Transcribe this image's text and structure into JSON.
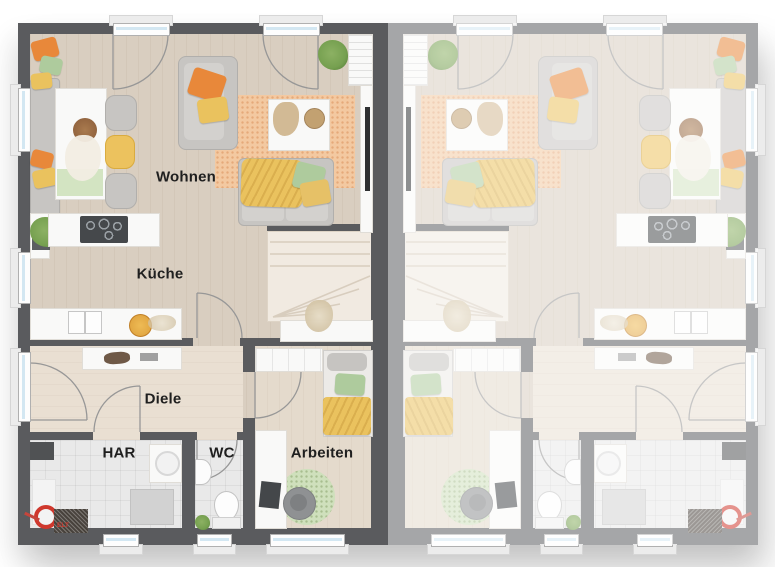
{
  "rooms": {
    "living": "Wohnen",
    "kitchen": "Küche",
    "hall": "Diele",
    "utility": "HAR",
    "wc": "WC",
    "office": "Arbeiten"
  },
  "markings": {
    "elt": "ELT"
  },
  "colors": {
    "wall": "#5a5b5e",
    "floor_wood": "#d9cec0",
    "floor_wood2": "#e4dacc",
    "floor_hall": "#e9dfd2",
    "floor_tile": "#e9e9e9",
    "stairs_bg": "#f1eae1",
    "white_furniture": "#f9f9f8",
    "glass": "#d3e7f2",
    "rug": "#f3c9a1",
    "rug_round": "#cfe0bc",
    "sofa_gray": "#c7c5c2",
    "accent_orange": "#e8883a",
    "accent_yellow": "#eac25e",
    "accent_green": "#aecb9d",
    "plant_green": "#76a050",
    "elt_red": "#cf382d",
    "label_color": "#1f1f1f"
  }
}
